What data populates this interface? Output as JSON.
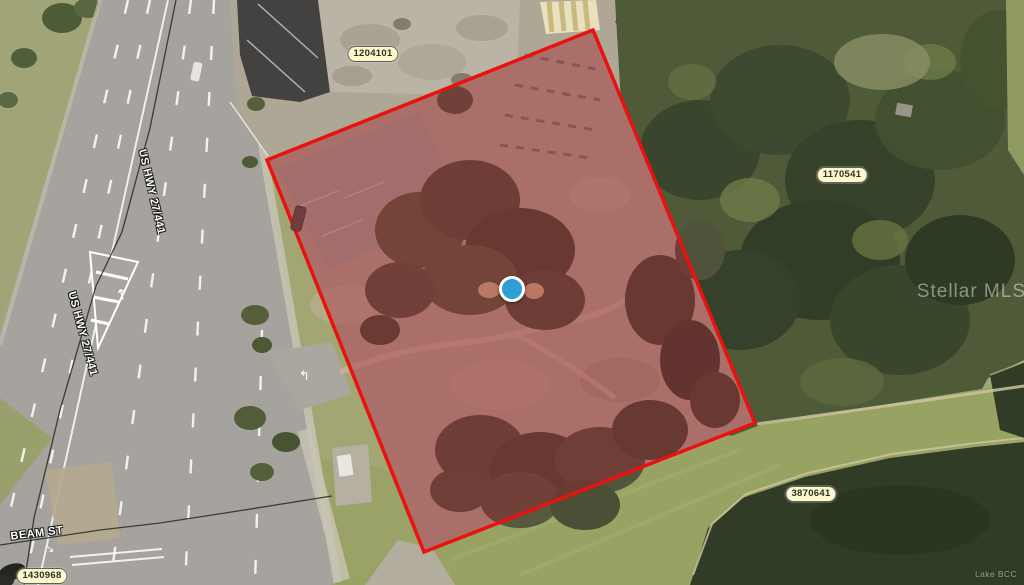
{
  "map": {
    "description": "Aerial parcel map with highlighted property boundary",
    "watermarks": {
      "primary": "Stellar MLS",
      "secondary": "Lake BCC"
    },
    "parcel_badges": [
      {
        "id": "1204101"
      },
      {
        "id": "1170541"
      },
      {
        "id": "3870641"
      },
      {
        "id": "1430968"
      }
    ],
    "road_labels": [
      {
        "text": "US HWY 27/441"
      },
      {
        "text": "US HWY 27/441"
      },
      {
        "text": "BEAM ST"
      }
    ],
    "marker": {
      "name": "property-location-marker",
      "color": "#2e9fd4"
    },
    "parcel_boundary": {
      "points": "267,160 593,30 755,423 424,552",
      "stroke": "#e8120f",
      "fill": "rgba(158,30,48,0.38)"
    }
  }
}
